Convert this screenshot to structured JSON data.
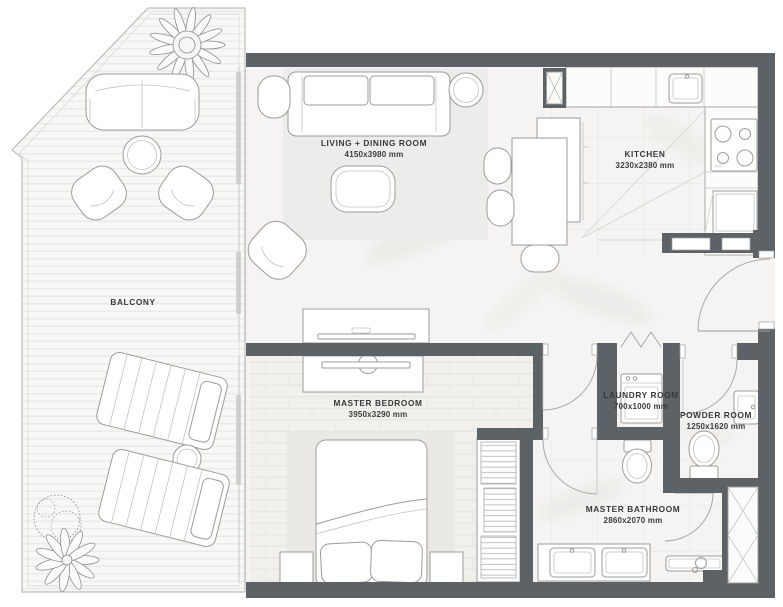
{
  "rooms": {
    "living": {
      "name": "LIVING + DINING ROOM",
      "dims": "4150x3980 mm"
    },
    "kitchen": {
      "name": "KITCHEN",
      "dims": "3230x2380 mm"
    },
    "balcony": {
      "name": "BALCONY"
    },
    "bedroom": {
      "name": "MASTER BEDROOM",
      "dims": "3950x3290 mm"
    },
    "laundry": {
      "name": "LAUNDRY ROOM",
      "dims": "700x1000 mm"
    },
    "powder": {
      "name": "POWDER ROOM",
      "dims": "1250x1620 mm"
    },
    "bathroom": {
      "name": "MASTER BATHROOM",
      "dims": "2860x2070 mm"
    }
  },
  "colors": {
    "wall": "#5d6266",
    "outline": "#9b9b9b",
    "floor": "#f5f4f2",
    "rug": "#ececea",
    "label_text": "#383838"
  }
}
